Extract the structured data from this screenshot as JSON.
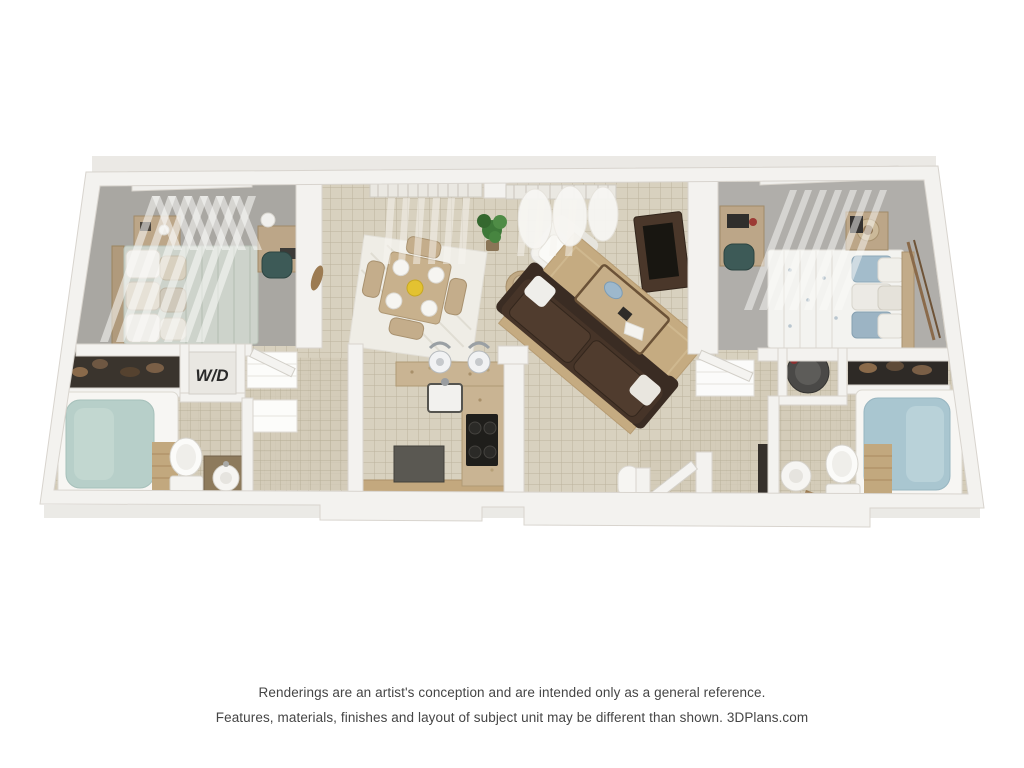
{
  "page": {
    "background_color": "#ffffff"
  },
  "floorplan": {
    "kind": "3d-floorplan-rendering",
    "labels": {
      "washer_dryer": "W/D"
    },
    "rooms": [
      "bedroom-left",
      "bathroom-left",
      "washer-dryer-closet",
      "dining-area",
      "kitchen",
      "living-room",
      "entry",
      "bedroom-right",
      "bathroom-right"
    ],
    "colors": {
      "background": "#ffffff",
      "wall": "#f3f2ef",
      "wall_shadow": "#d8d4ce",
      "tile_floor": "#d8d1bf",
      "tile_grout": "#b9b09a",
      "carpet": "#a9a7a2",
      "counter_granite": "#c9b493",
      "cabinet_tan": "#c3a87e",
      "sofa_brown": "#463428",
      "area_rug_tan": "#c5ab81",
      "dining_rug_white": "#efede6",
      "wood_trim": "#6b5237",
      "bedding_sage": "#cdd3cb",
      "bedding_white": "#f3f3f0",
      "pillow_blue": "#a3bccb",
      "plant_green": "#3e7939",
      "accent_yellow": "#e3c231",
      "tub_water_left": "#b7cfc9",
      "tub_water_right": "#a9c6d0",
      "appliance_gray": "#5a5852",
      "stove_black": "#1f1e1b",
      "caption_text": "#454545"
    }
  },
  "disclaimer": {
    "line1": "Renderings are an artist's conception and are intended only as a general reference.",
    "line2": "Features, materials, finishes and layout of subject unit may be different than shown. 3DPlans.com"
  }
}
